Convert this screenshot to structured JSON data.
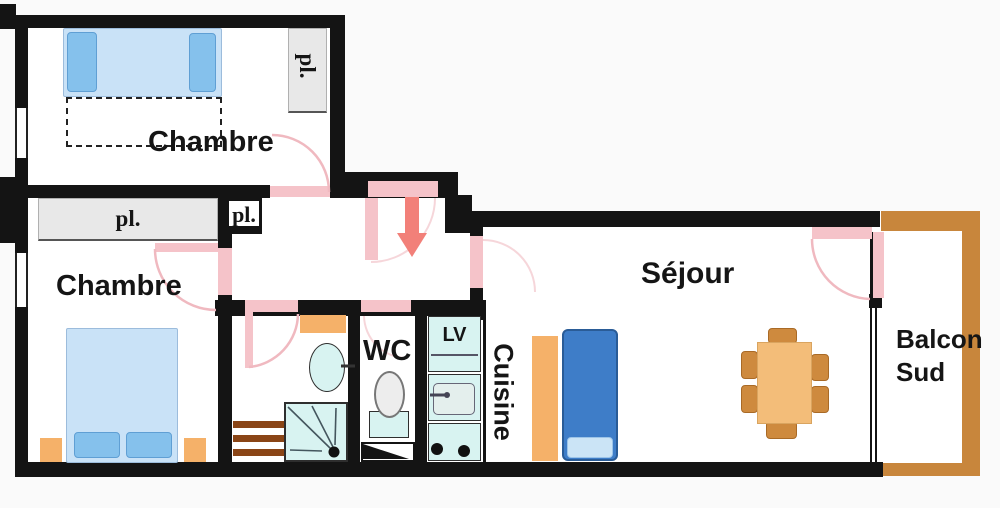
{
  "plan": {
    "type": "apartment-floor-plan",
    "rooms": {
      "bedroom_top": {
        "label": "Chambre"
      },
      "bedroom_left": {
        "label": "Chambre"
      },
      "living": {
        "label": "Séjour"
      },
      "kitchen": {
        "label": "Cuisine"
      },
      "wc": {
        "label": "WC"
      },
      "balcony": {
        "label": "Balcon Sud"
      }
    },
    "closets": {
      "top_bedroom": "pl.",
      "left_bedroom": "pl.",
      "hall": "pl."
    },
    "appliances": {
      "dishwasher": "LV"
    },
    "colors": {
      "wall": "#141414",
      "door": "#f5c3c9",
      "door_arc": "#f0b9c0",
      "arrow": "#f28079",
      "bed": "#c9e2f7",
      "pillow": "#85c1ec",
      "furniture_orange": "#f5b169",
      "table": "#f3bd79",
      "chair": "#ce8a3e",
      "sofa": "#3e7dc8",
      "fixture": "#d8f3f1",
      "balcony": "#c8863c",
      "closet": "#e8e8e8",
      "radiator": "#8a4516"
    }
  }
}
